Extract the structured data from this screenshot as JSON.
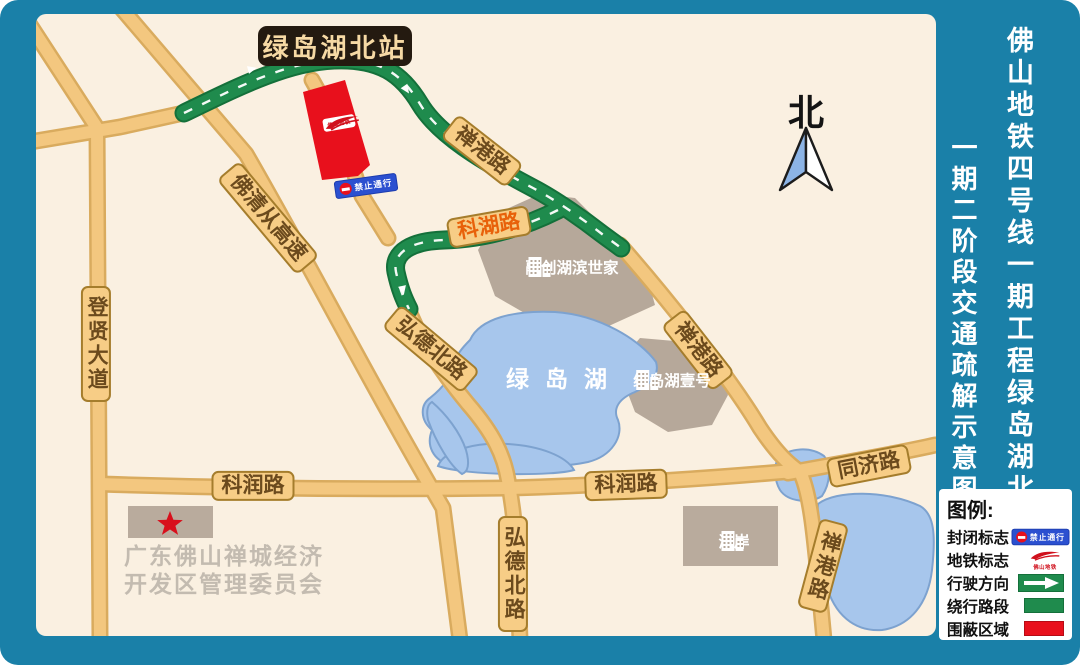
{
  "title_panel": {
    "line1": "佛山地铁四号线一期工程绿岛湖北站",
    "line2": "一期二阶段交通疏解示意图"
  },
  "station_badge": "绿岛湖北站",
  "north_label": "北",
  "map": {
    "lake_label": "绿岛湖",
    "committee": {
      "line1": "广东佛山禅城经济",
      "line2": "开发区管理委员会"
    },
    "road_labels": [
      {
        "text": "禅港路",
        "x": 446,
        "y": 137,
        "rot": 38
      },
      {
        "text": "科湖路",
        "x": 453,
        "y": 213,
        "rot": -10,
        "color": "#e8610a"
      },
      {
        "text": "佛清从高速",
        "x": 232,
        "y": 204,
        "rot": 50
      },
      {
        "text": "登贤大道",
        "x": 60,
        "y": 330,
        "vertical": true
      },
      {
        "text": "弘德北路",
        "x": 395,
        "y": 335,
        "rot": 40
      },
      {
        "text": "弘德北路",
        "x": 477,
        "y": 560,
        "vertical": true
      },
      {
        "text": "科润路",
        "x": 217,
        "y": 472
      },
      {
        "text": "科润路",
        "x": 590,
        "y": 471,
        "rot": -2
      },
      {
        "text": "同济路",
        "x": 833,
        "y": 452,
        "rot": -11
      },
      {
        "text": "禅港路",
        "x": 662,
        "y": 336,
        "rot": 52
      },
      {
        "text": "禅港路",
        "x": 787,
        "y": 552,
        "vertical": true,
        "rot": 15
      }
    ],
    "places": [
      {
        "name": "融创湖滨世家",
        "x": 536,
        "y": 252
      },
      {
        "name": "绿岛湖壹号",
        "x": 636,
        "y": 365
      },
      {
        "name": "涟岸",
        "x": 698,
        "y": 526
      }
    ],
    "signs": {
      "closure_text": "禁止通行",
      "metro_text": "佛山地铁"
    }
  },
  "legend": {
    "title": "图例:",
    "rows": [
      {
        "label": "封闭标志",
        "icon": "closure-sign"
      },
      {
        "label": "地铁标志",
        "icon": "metro-logo"
      },
      {
        "label": "行驶方向",
        "icon": "direction-arrow"
      },
      {
        "label": "绕行路段",
        "icon": "detour-swatch"
      },
      {
        "label": "围蔽区域",
        "icon": "enclosed-swatch"
      }
    ]
  },
  "colors": {
    "frame_teal": "#1a80a8",
    "map_cream": "#faf0e1",
    "road_tan": "#f3c77f",
    "road_casing": "#d9ab5e",
    "detour_green": "#1f8b4d",
    "enclosed_red": "#e8101c",
    "lake_blue": "#a7c6ec",
    "building_gray": "#b6a89a",
    "sign_blue": "#2b50d0"
  }
}
